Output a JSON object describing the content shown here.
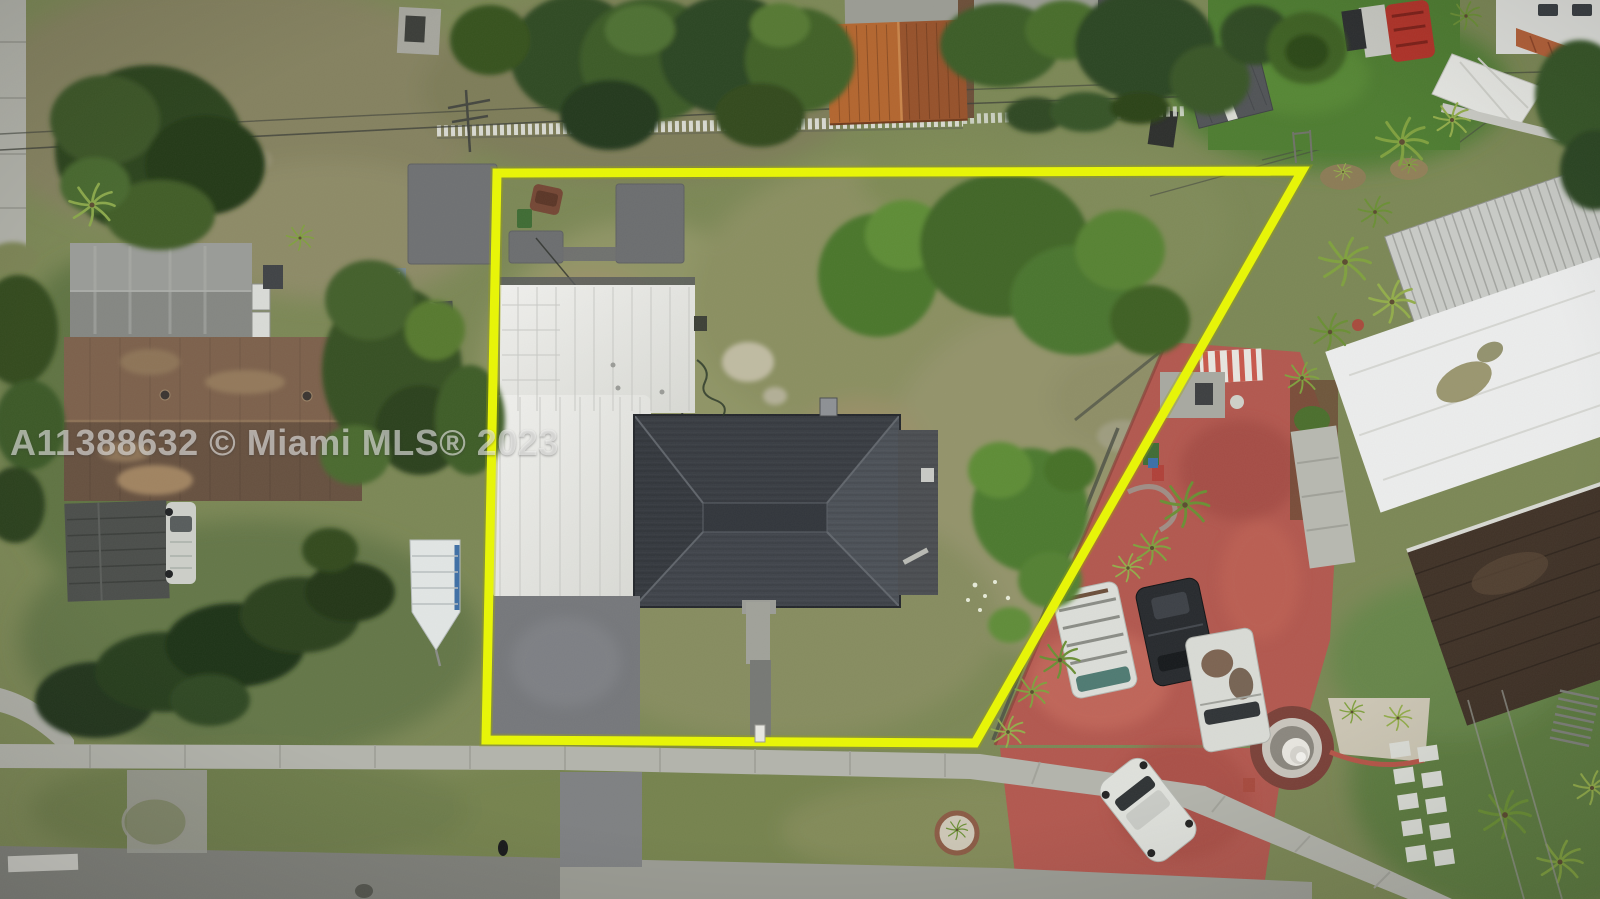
{
  "watermark": {
    "text": "A11388632 © Miami MLS® 2023",
    "listing_id": "A11388632",
    "source": "Miami MLS®",
    "year": "2023"
  },
  "scene": {
    "type": "aerial-drone-photo-of-residential-lot",
    "boundary_overlay": {
      "color": "#e9f703",
      "shape": "quadrilateral",
      "corners": [
        [
          497,
          173
        ],
        [
          1302,
          171
        ],
        [
          975,
          743
        ],
        [
          486,
          740
        ]
      ]
    },
    "subject_property": {
      "house_roof_color": "#3e434a",
      "carport_roof_color": "#e9eae6",
      "driveway_color": "#75777b",
      "lawn_color": "#8f9465"
    },
    "surroundings": {
      "left_house_roof_color": "#6f5544",
      "left_gable_roof_color": "#8e908c",
      "orange_roof_color": "#b3652e",
      "red_driveway_color": "#b2574e",
      "metal_roof_color": "#c9cbc7",
      "street_color": "#84857f",
      "sidewalk_color": "#b3b4ac",
      "picket_fence_color": "#dfe1db",
      "turf_color": "#4d7c30"
    },
    "vehicles": [
      "white-van-roof-rack",
      "black-suv",
      "white-pickup-truck",
      "white-sedan",
      "old-white-truck",
      "brown-car"
    ],
    "landmarks": [
      "tiered-fountain",
      "boat-trailer",
      "striped-awning",
      "white-picket-fence",
      "palm-trees",
      "conifer-tree",
      "stepping-stones",
      "round-planter"
    ]
  }
}
